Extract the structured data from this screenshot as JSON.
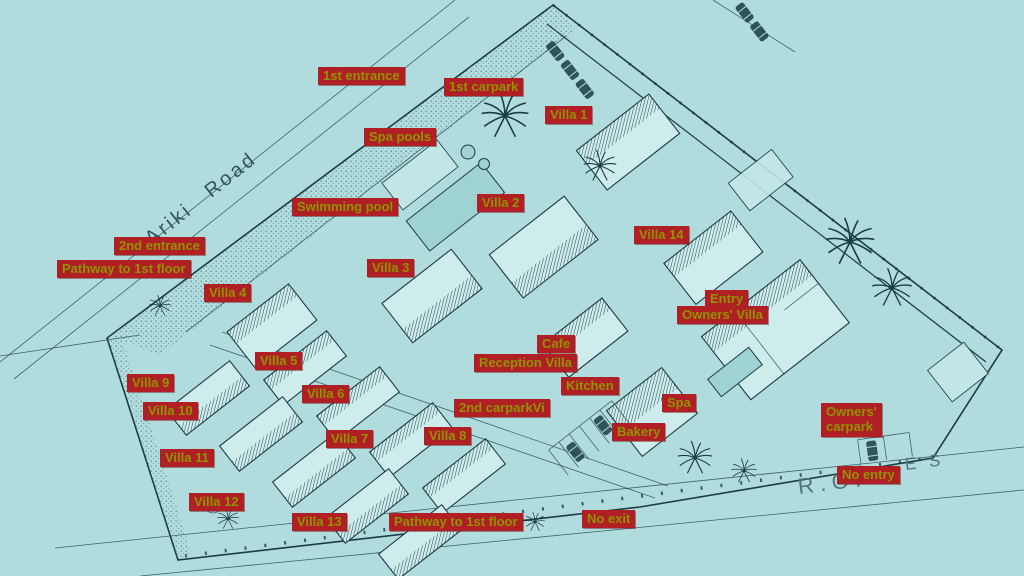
{
  "map": {
    "title_road": "Ariki Road",
    "row_text_left": "R.O. .",
    "row_text_right": "E S",
    "colors": {
      "background": "#b1dcde",
      "line": "#1b3b45",
      "label_bg": "#b01f24",
      "label_text": "#8f9400",
      "pool": "#9fd2d3"
    }
  },
  "labels": [
    {
      "id": "first-entrance",
      "text": "1st entrance",
      "x": 318,
      "y": 67
    },
    {
      "id": "first-carpark",
      "text": "1st carpark",
      "x": 444,
      "y": 78
    },
    {
      "id": "villa-1",
      "text": "Villa 1",
      "x": 545,
      "y": 106
    },
    {
      "id": "spa-pools",
      "text": "Spa pools",
      "x": 364,
      "y": 128
    },
    {
      "id": "swimming-pool",
      "text": "Swimming pool",
      "x": 292,
      "y": 198
    },
    {
      "id": "villa-2",
      "text": "Villa 2",
      "x": 477,
      "y": 194
    },
    {
      "id": "villa-14",
      "text": "Villa 14",
      "x": 634,
      "y": 226
    },
    {
      "id": "second-entrance",
      "text": "2nd entrance",
      "x": 114,
      "y": 237
    },
    {
      "id": "pathway-to-1st-floor-upper",
      "text": "Pathway to 1st floor",
      "x": 57,
      "y": 260
    },
    {
      "id": "villa-3",
      "text": "Villa 3",
      "x": 367,
      "y": 259
    },
    {
      "id": "villa-4",
      "text": "Villa 4",
      "x": 204,
      "y": 284
    },
    {
      "id": "entry",
      "text": "Entry",
      "x": 705,
      "y": 290
    },
    {
      "id": "owners-villa",
      "text": "Owners' Villa",
      "x": 677,
      "y": 306
    },
    {
      "id": "cafe",
      "text": "Cafe",
      "x": 537,
      "y": 335
    },
    {
      "id": "villa-5",
      "text": "Villa 5",
      "x": 255,
      "y": 352
    },
    {
      "id": "reception-villa",
      "text": "Reception Villa",
      "x": 474,
      "y": 354
    },
    {
      "id": "villa-9",
      "text": "Villa 9",
      "x": 127,
      "y": 374
    },
    {
      "id": "kitchen",
      "text": "Kitchen",
      "x": 561,
      "y": 377
    },
    {
      "id": "villa-6",
      "text": "Villa 6",
      "x": 302,
      "y": 385
    },
    {
      "id": "spa",
      "text": "Spa",
      "x": 662,
      "y": 394
    },
    {
      "id": "second-carpark",
      "text": "2nd carparkVi",
      "x": 454,
      "y": 399
    },
    {
      "id": "villa-10",
      "text": "Villa 10",
      "x": 143,
      "y": 402
    },
    {
      "id": "owners-carpark",
      "text": "Owners'\ncarpark",
      "x": 821,
      "y": 403
    },
    {
      "id": "bakery",
      "text": "Bakery",
      "x": 612,
      "y": 423
    },
    {
      "id": "villa-8",
      "text": "Villa 8",
      "x": 424,
      "y": 427
    },
    {
      "id": "villa-7",
      "text": "Villa 7",
      "x": 326,
      "y": 430
    },
    {
      "id": "villa-11",
      "text": "Villa 11",
      "x": 160,
      "y": 449
    },
    {
      "id": "no-entry",
      "text": "No entry",
      "x": 837,
      "y": 466
    },
    {
      "id": "villa-12",
      "text": "Villa 12",
      "x": 189,
      "y": 493
    },
    {
      "id": "no-exit",
      "text": "No exit",
      "x": 582,
      "y": 510
    },
    {
      "id": "villa-13",
      "text": "Villa 13",
      "x": 292,
      "y": 513
    },
    {
      "id": "pathway-to-1st-floor-lower",
      "text": "Pathway to 1st floor",
      "x": 389,
      "y": 513
    }
  ]
}
